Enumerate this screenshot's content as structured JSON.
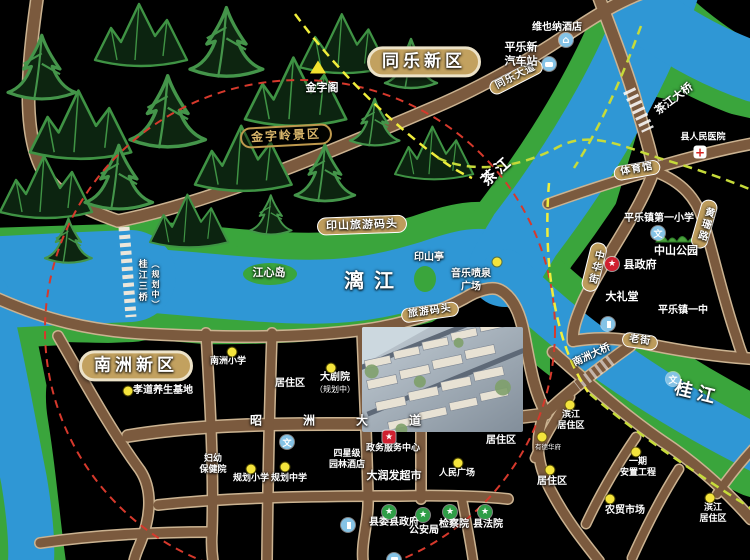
{
  "map": {
    "colors": {
      "land": "#000000",
      "water": "#2f97d5",
      "bank_green": "#3aa53c",
      "road_fill": "#7b5a3e",
      "road_edge": "#cbb391",
      "plaque": "#bd9c5c",
      "district_plaque": "#c2a15f",
      "dash_red": "#d6392c",
      "dash_yellow": "#f0ee3c",
      "dash_green": "#c6db3a",
      "poi_dot": "#f4e43c",
      "icon_blue": "#85c3e6",
      "icon_red": "#cf2030",
      "icon_green": "#2f9e47"
    },
    "labels": [
      {
        "name": "district-tongle-new-area",
        "text": "同乐新区",
        "x": 424,
        "y": 62,
        "cls": "district"
      },
      {
        "name": "district-nanzhou-new-area",
        "text": "南洲新区",
        "x": 136,
        "y": 366,
        "cls": "district"
      },
      {
        "name": "scenic-jinziling",
        "text": "金字岭景区",
        "x": 286,
        "y": 136,
        "cls": "outline",
        "rot": -3
      },
      {
        "name": "wharf-yinshan",
        "text": "印山旅游码头",
        "x": 362,
        "y": 225,
        "cls": "plaque",
        "rot": -2
      },
      {
        "name": "wharf-tour",
        "text": "旅游码头",
        "x": 430,
        "y": 312,
        "cls": "plaque sm",
        "rot": -8
      },
      {
        "name": "gymnasium",
        "text": "体育馆",
        "x": 637,
        "y": 170,
        "cls": "plaque sm",
        "rot": -10
      },
      {
        "name": "laojie-street",
        "text": "老街",
        "x": 640,
        "y": 341,
        "cls": "plaque sm",
        "rot": 8
      },
      {
        "name": "tongle-avenue",
        "text": "同乐大道",
        "x": 516,
        "y": 77,
        "cls": "plaque sm",
        "rot": -27
      },
      {
        "name": "zhaozhou-avenue",
        "text": "昭洲大道",
        "x": 356,
        "y": 421,
        "cls": "spread"
      },
      {
        "name": "zhonghua-street",
        "text": "中华街",
        "x": 594,
        "y": 267,
        "cls": "plaque sm vert",
        "rot": 14
      },
      {
        "name": "huangshan-road",
        "text": "黄珊路",
        "x": 704,
        "y": 224,
        "cls": "plaque sm vert",
        "rot": 16
      },
      {
        "name": "chajiang-bridge",
        "text": "茶江大桥",
        "x": 674,
        "y": 99,
        "cls": "md",
        "rot": -37
      },
      {
        "name": "nanzhou-bridge",
        "text": "南洲大桥",
        "x": 592,
        "y": 356,
        "rot": -25
      },
      {
        "name": "guijiang-bridge3",
        "text": "桂江三桥",
        "x": 141,
        "y": 281,
        "cls": "vert sm"
      },
      {
        "name": "guijiang-bridge3-note",
        "text": "（规划中）",
        "x": 155,
        "y": 285,
        "cls": "vert xs"
      },
      {
        "name": "river-lijiang",
        "text": "漓江",
        "x": 374,
        "y": 281,
        "cls": "river big"
      },
      {
        "name": "river-guijiang",
        "text": "桂江",
        "x": 697,
        "y": 394,
        "cls": "river gui",
        "rot": 14
      },
      {
        "name": "river-chajiang",
        "text": "茶江",
        "x": 497,
        "y": 171,
        "cls": "river",
        "rot": -42
      },
      {
        "name": "jinzige-pavilion",
        "text": "金字阁",
        "x": 322,
        "y": 88,
        "cls": "md"
      },
      {
        "name": "vienna-hotel",
        "text": "维也纳酒店",
        "x": 557,
        "y": 28
      },
      {
        "name": "new-bus-station",
        "lines": [
          "平乐新",
          "汽车站"
        ],
        "x": 521,
        "y": 54,
        "cls": "md"
      },
      {
        "name": "county-hospital",
        "text": "县人民医院",
        "x": 703,
        "y": 138,
        "cls": "sm"
      },
      {
        "name": "pingle-no1-primary",
        "text": "平乐镇第一小学",
        "x": 659,
        "y": 219
      },
      {
        "name": "zhongshan-park",
        "text": "中山公园",
        "x": 676,
        "y": 251,
        "cls": "md"
      },
      {
        "name": "county-government",
        "text": "县政府",
        "x": 640,
        "y": 265,
        "cls": "md"
      },
      {
        "name": "grand-hall",
        "text": "大礼堂",
        "x": 622,
        "y": 297,
        "cls": "md"
      },
      {
        "name": "pingle-no1-middle",
        "text": "平乐镇一中",
        "x": 683,
        "y": 311
      },
      {
        "name": "yinshan-pavilion",
        "text": "印山亭",
        "x": 429,
        "y": 258
      },
      {
        "name": "music-fountain-square",
        "lines": [
          "音乐喷泉",
          "广场"
        ],
        "x": 471,
        "y": 281
      },
      {
        "name": "jiangxin-island",
        "text": "江心岛",
        "x": 269,
        "y": 273,
        "cls": "md"
      },
      {
        "name": "xiaodao-health-base",
        "text": "孝道养生基地",
        "x": 163,
        "y": 391
      },
      {
        "name": "nanzhou-primary",
        "text": "南洲小学",
        "x": 228,
        "y": 362,
        "cls": "sm"
      },
      {
        "name": "residential-west",
        "text": "居住区",
        "x": 290,
        "y": 384
      },
      {
        "name": "grand-theater",
        "lines": [
          "大剧院",
          "（规划中）"
        ],
        "x": 335,
        "y": 383,
        "cls": "sub"
      },
      {
        "name": "maternal-hospital",
        "lines": [
          "妇幼",
          "保健院"
        ],
        "x": 213,
        "y": 465,
        "cls": "sm"
      },
      {
        "name": "planned-primary",
        "text": "规划小学",
        "x": 251,
        "y": 479,
        "cls": "sm"
      },
      {
        "name": "planned-middle",
        "text": "规划中学",
        "x": 289,
        "y": 479,
        "cls": "sm"
      },
      {
        "name": "garden-hotel",
        "lines": [
          "四星级",
          "园林酒店"
        ],
        "x": 347,
        "y": 460,
        "cls": "sm"
      },
      {
        "name": "gov-service-center",
        "text": "政务服务中心",
        "x": 393,
        "y": 449,
        "cls": "sm"
      },
      {
        "name": "rt-mart-supermarket",
        "text": "大润发超市",
        "x": 394,
        "y": 476,
        "cls": "md"
      },
      {
        "name": "peoples-square",
        "text": "人民广场",
        "x": 457,
        "y": 474,
        "cls": "sm"
      },
      {
        "name": "residential-center",
        "text": "居住区",
        "x": 501,
        "y": 441
      },
      {
        "name": "county-committee",
        "text": "县委县政府",
        "x": 394,
        "y": 523
      },
      {
        "name": "public-security-bureau",
        "text": "公安局",
        "x": 424,
        "y": 531
      },
      {
        "name": "procuratorate",
        "text": "检察院",
        "x": 454,
        "y": 525
      },
      {
        "name": "county-court",
        "text": "县法院",
        "x": 488,
        "y": 525
      },
      {
        "name": "binjiang-residential-north",
        "lines": [
          "滨江",
          "居住区"
        ],
        "x": 571,
        "y": 421,
        "cls": "sm"
      },
      {
        "name": "youde-huafu",
        "text": "有德华府",
        "x": 548,
        "y": 447,
        "cls": "tiny"
      },
      {
        "name": "residential-east",
        "text": "居住区",
        "x": 552,
        "y": 482
      },
      {
        "name": "phase1-resettlement",
        "lines": [
          "一期",
          "安置工程"
        ],
        "x": 638,
        "y": 468,
        "cls": "sm"
      },
      {
        "name": "farmers-market",
        "text": "农贸市场",
        "x": 625,
        "y": 511
      },
      {
        "name": "binjiang-residential-south",
        "lines": [
          "滨江",
          "居住区"
        ],
        "x": 713,
        "y": 514,
        "cls": "sm"
      }
    ],
    "markers": [
      {
        "name": "jinzige-triangle-icon",
        "type": "tri",
        "x": 318,
        "y": 67
      },
      {
        "name": "hotel-icon",
        "type": "hotel",
        "x": 566,
        "y": 40,
        "glyph": "⌂"
      },
      {
        "name": "bus-icon",
        "type": "bus",
        "x": 549,
        "y": 50
      },
      {
        "name": "hospital-cross-icon",
        "type": "hospital",
        "x": 700,
        "y": 152,
        "glyph": "+"
      },
      {
        "name": "school-icon-no1-primary",
        "type": "wen",
        "x": 658,
        "y": 205,
        "glyph": "文"
      },
      {
        "name": "gov-star-icon-county",
        "type": "red-star",
        "x": 612,
        "y": 264,
        "glyph": "★"
      },
      {
        "name": "hall-icon",
        "type": "bldg",
        "x": 608,
        "y": 282
      },
      {
        "name": "school-icon-no1-middle",
        "type": "wen",
        "x": 673,
        "y": 323,
        "glyph": "文"
      },
      {
        "name": "fountain-dot",
        "type": "dot",
        "x": 497,
        "y": 262
      },
      {
        "name": "xiaodao-dot",
        "type": "dot",
        "x": 128,
        "y": 391
      },
      {
        "name": "nanzhou-primary-dot",
        "type": "dot",
        "x": 232,
        "y": 352
      },
      {
        "name": "school-icon-residential-west",
        "type": "wen",
        "x": 287,
        "y": 372,
        "glyph": "文"
      },
      {
        "name": "theater-dot",
        "type": "dot",
        "x": 331,
        "y": 368
      },
      {
        "name": "planned-primary-dot",
        "type": "dot",
        "x": 251,
        "y": 469
      },
      {
        "name": "planned-middle-dot",
        "type": "dot",
        "x": 285,
        "y": 467
      },
      {
        "name": "garden-hotel-icon",
        "type": "bldg",
        "x": 348,
        "y": 441
      },
      {
        "name": "gov-service-star-icon",
        "type": "red-box-star",
        "x": 389,
        "y": 437,
        "glyph": "★"
      },
      {
        "name": "supermarket-icon",
        "type": "store",
        "x": 394,
        "y": 462
      },
      {
        "name": "peoples-square-dot",
        "type": "dot",
        "x": 458,
        "y": 463
      },
      {
        "name": "county-committee-star-icon",
        "type": "green-star",
        "x": 389,
        "y": 512,
        "glyph": "★"
      },
      {
        "name": "police-star-icon",
        "type": "green-star",
        "x": 423,
        "y": 515,
        "glyph": "★"
      },
      {
        "name": "procuratorate-star-icon",
        "type": "green-star",
        "x": 450,
        "y": 512,
        "glyph": "★"
      },
      {
        "name": "court-star-icon",
        "type": "green-star",
        "x": 485,
        "y": 512,
        "glyph": "★"
      },
      {
        "name": "binjiang-north-dot",
        "type": "dot",
        "x": 570,
        "y": 405
      },
      {
        "name": "youde-dot",
        "type": "dot",
        "x": 542,
        "y": 437
      },
      {
        "name": "residential-east-dot",
        "type": "dot",
        "x": 550,
        "y": 470
      },
      {
        "name": "phase1-dot",
        "type": "dot",
        "x": 636,
        "y": 452
      },
      {
        "name": "farmers-market-dot",
        "type": "dot",
        "x": 610,
        "y": 499
      },
      {
        "name": "binjiang-south-dot",
        "type": "dot",
        "x": 710,
        "y": 498
      }
    ]
  }
}
